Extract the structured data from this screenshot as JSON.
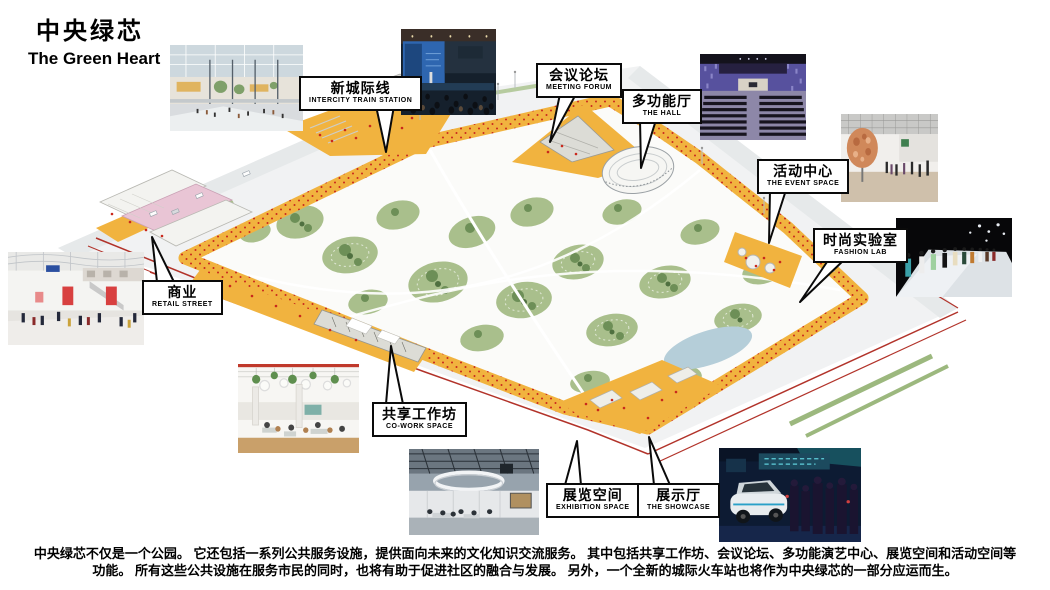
{
  "slide": {
    "title_zh": "中央绿芯",
    "title_en": "The Green Heart",
    "description_line1": "中央绿芯不仅是一个公园。 它还包括一系列公共服务设施，提供面向未来的文化知识交流服务。 其中包括共享工作坊、会议论坛、多功能演艺中心、展览空间和活动空间等",
    "description_line2": "功能。 所有这些公共设施在服务市民的同时，也将有助于促进社区的融合与发展。 另外，一个全新的城际火车站也将作为中央绿芯的一部分应运而生。"
  },
  "callouts": [
    {
      "zh": "新城际线",
      "en": "INTERCITY TRAIN STATION"
    },
    {
      "zh": "会议论坛",
      "en": "MEETING FORUM"
    },
    {
      "zh": "多功能厅",
      "en": "THE HALL"
    },
    {
      "zh": "活动中心",
      "en": "THE EVENT SPACE"
    },
    {
      "zh": "时尚实验室",
      "en": "FASHION LAB"
    },
    {
      "zh": "商业",
      "en": "RETAIL STREET"
    },
    {
      "zh": "共享工作坊",
      "en": "CO-WORK SPACE"
    },
    {
      "zh": "展览空间",
      "en": "EXHIBITION SPACE"
    },
    {
      "zh": "展示厅",
      "en": "THE SHOWCASE"
    }
  ],
  "photos": [
    {
      "name": "mall-atrium-render"
    },
    {
      "name": "conference-forum"
    },
    {
      "name": "auditorium-hall"
    },
    {
      "name": "gallery-sphere-event"
    },
    {
      "name": "fashion-runway"
    },
    {
      "name": "retail-mall-interior"
    },
    {
      "name": "co-work-cafe"
    },
    {
      "name": "exhibition-hall-ring"
    },
    {
      "name": "car-showcase"
    }
  ],
  "colors": {
    "deck_orange": "#f1b33f",
    "park_green": "#a9bf8c",
    "tree_green": "#6d8f57",
    "road_grey": "#f1f2f3",
    "accent_red": "#b2332a",
    "pond_blue": "#b5ced9",
    "text_black": "#111111"
  }
}
